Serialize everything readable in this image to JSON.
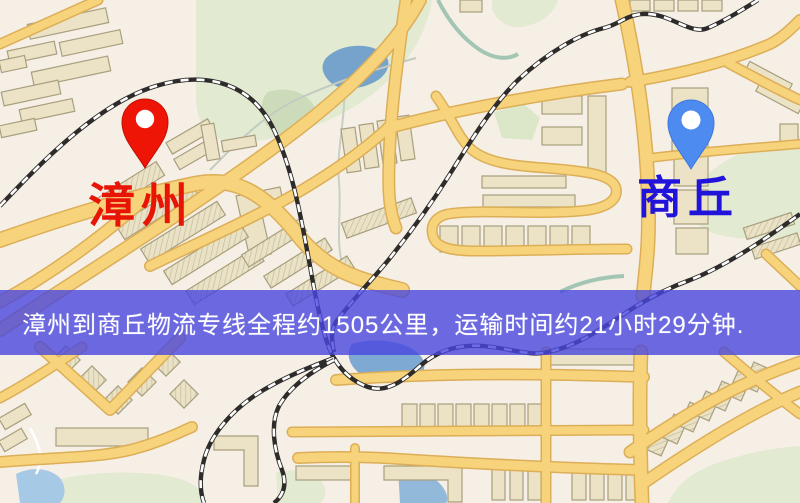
{
  "map": {
    "description": "stylized city road map",
    "origin": {
      "label": "漳州",
      "pin_color": "#ee1506",
      "label_color": "#e81405"
    },
    "destination": {
      "label": "商丘",
      "pin_color": "#4e8bf0",
      "label_color": "#2013da"
    }
  },
  "banner": {
    "text": "漳州到商丘物流专线全程约1505公里，运输时间约21小时29分钟.",
    "background": "rgba(72,70,222,0.80)",
    "text_color": "#ffffff"
  },
  "route": {
    "from": "漳州",
    "to": "商丘",
    "distance_text": "约1505公里",
    "duration_text": "约21小时29分钟"
  },
  "palette": {
    "map_background": "#f6efe6",
    "road_fill": "#f7d47c",
    "road_casing": "#dcae57",
    "building_fill": "#ece3c6",
    "park_green": "#e2ead2",
    "water_blue": "#7ea9d2",
    "railway_dark": "#2e2c2a"
  }
}
